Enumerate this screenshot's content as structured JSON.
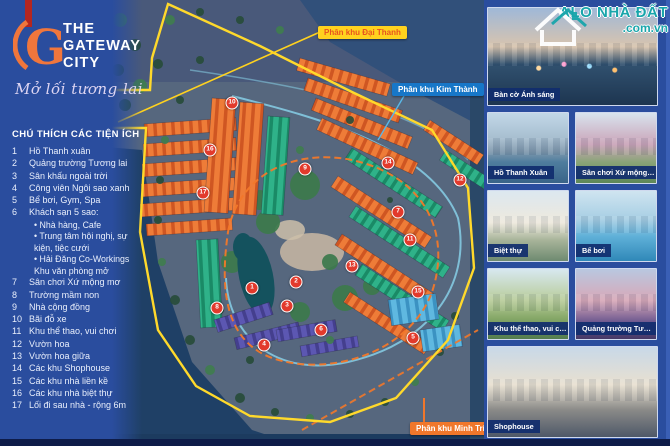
{
  "logo": {
    "monogram": "G",
    "title_line1": "THE",
    "title_line2": "GATEWAY",
    "title_line3": "CITY",
    "tagline": "Mở lối tương lai"
  },
  "legend": {
    "heading": "CHÚ THÍCH CÁC TIỆN ÍCH",
    "items": [
      {
        "num": "1",
        "label": "Hồ Thanh xuân"
      },
      {
        "num": "2",
        "label": "Quảng trường Tương lai"
      },
      {
        "num": "3",
        "label": "Sân khấu ngoài trời"
      },
      {
        "num": "4",
        "label": "Công viên Ngôi sao xanh"
      },
      {
        "num": "5",
        "label": "Bể bơi, Gym, Spa"
      },
      {
        "num": "6",
        "label": "Khách sạn 5 sao:",
        "sub": [
          "Nhà hàng, Cafe",
          "Trung tâm hội nghị, sự kiện, tiệc cưới",
          "Hải Đăng Co-Workings Khu văn phòng mở"
        ]
      },
      {
        "num": "7",
        "label": "Sân chơi Xứ mộng mơ"
      },
      {
        "num": "8",
        "label": "Trường mầm non"
      },
      {
        "num": "9",
        "label": "Nhà cộng đồng"
      },
      {
        "num": "10",
        "label": "Bãi đỗ xe"
      },
      {
        "num": "11",
        "label": "Khu thể thao, vui chơi"
      },
      {
        "num": "12",
        "label": "Vườn hoa"
      },
      {
        "num": "13",
        "label": "Vườn hoa giữa"
      },
      {
        "num": "14",
        "label": "Các khu Shophouse"
      },
      {
        "num": "15",
        "label": "Các khu nhà liền kề"
      },
      {
        "num": "16",
        "label": "Các khu nhà biệt thự"
      },
      {
        "num": "17",
        "label": "Lối đi sau nhà - rộng 6m"
      }
    ]
  },
  "map": {
    "zone_labels": [
      {
        "text": "Phân khu Đại Thanh",
        "style": "yellow"
      },
      {
        "text": "Phân khu Kim Thành",
        "style": "blue"
      },
      {
        "text": "Phân khu Minh Trí",
        "style": "orange"
      }
    ],
    "markers": [
      {
        "n": "1",
        "x": 252,
        "y": 288
      },
      {
        "n": "2",
        "x": 296,
        "y": 282
      },
      {
        "n": "3",
        "x": 287,
        "y": 306
      },
      {
        "n": "4",
        "x": 264,
        "y": 345
      },
      {
        "n": "5",
        "x": 413,
        "y": 338
      },
      {
        "n": "6",
        "x": 321,
        "y": 330
      },
      {
        "n": "7",
        "x": 398,
        "y": 212
      },
      {
        "n": "8",
        "x": 217,
        "y": 308
      },
      {
        "n": "9",
        "x": 305,
        "y": 169
      },
      {
        "n": "10",
        "x": 232,
        "y": 103
      },
      {
        "n": "11",
        "x": 410,
        "y": 240
      },
      {
        "n": "12",
        "x": 460,
        "y": 180
      },
      {
        "n": "13",
        "x": 352,
        "y": 266
      },
      {
        "n": "14",
        "x": 388,
        "y": 163
      },
      {
        "n": "15",
        "x": 418,
        "y": 292
      },
      {
        "n": "16",
        "x": 210,
        "y": 150
      },
      {
        "n": "17",
        "x": 203,
        "y": 193
      }
    ]
  },
  "sidebar": {
    "cards": [
      {
        "caption": "Bàn cờ Ánh sáng"
      },
      {
        "caption": "Hồ Thanh Xuân"
      },
      {
        "caption": "Sân chơi Xứ mộng mơ"
      },
      {
        "caption": "Biệt thự"
      },
      {
        "caption": "Bể bơi"
      },
      {
        "caption": "Khu thể thao, vui chơi"
      },
      {
        "caption": "Quảng trường Tương lai"
      },
      {
        "caption": "Shophouse"
      }
    ]
  },
  "watermark": {
    "line1": "ALO NHÀ ĐẤT",
    "line2": ".com.vn"
  },
  "colors": {
    "brand_orange": "#F0762A",
    "brand_navy": "#2A4D9E",
    "boundary_yellow": "#FFD92B",
    "marker_red": "#E23A2C",
    "teal_block": "#2FB289",
    "label_blue": "#1777C8"
  }
}
